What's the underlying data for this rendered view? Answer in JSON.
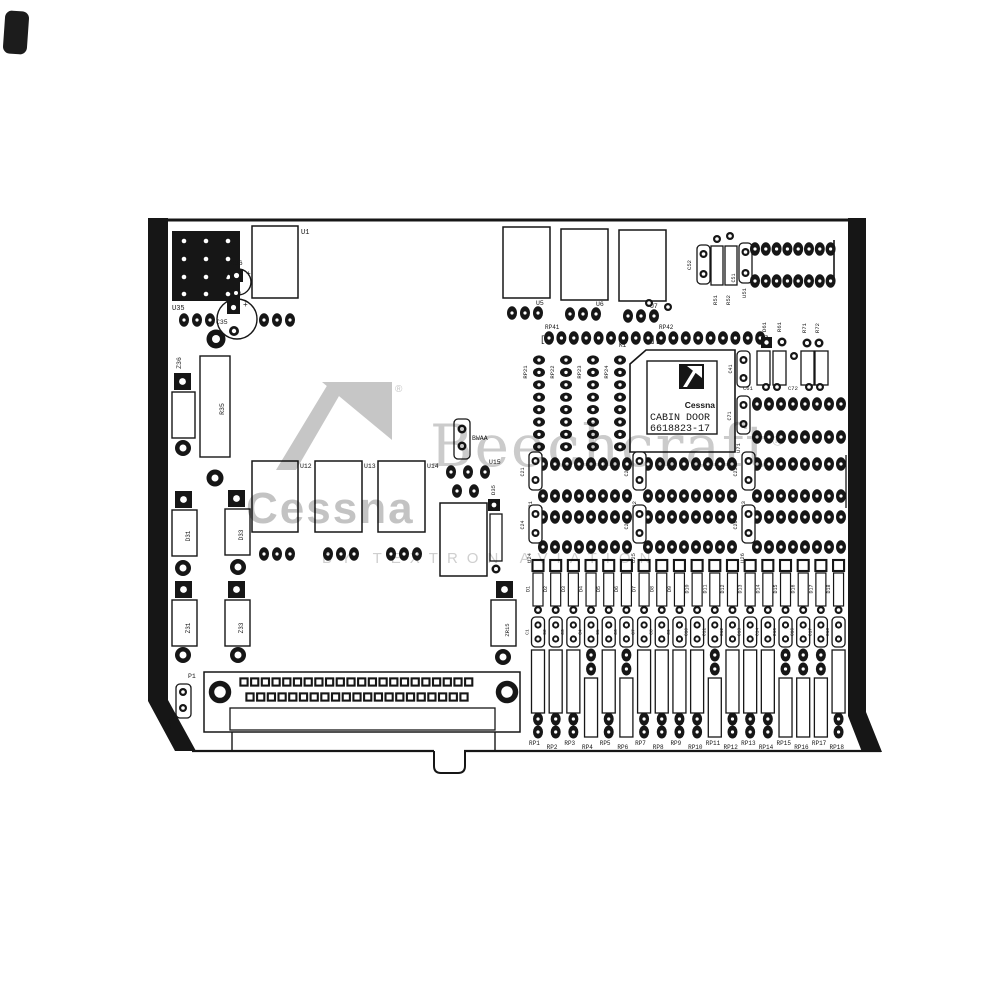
{
  "chip": {
    "brand": "Cessna",
    "product": "CABIN DOOR",
    "part_number": "6618823-17"
  },
  "watermark": {
    "cessna": "Cessna",
    "beechcraft": "Beechcraft",
    "tagline": "BY TEXTRON AVIATION",
    "reg": "®"
  },
  "glyphs": {
    "bracket_open": "[",
    "bracket_close": "]",
    "plus": "+"
  },
  "refdes": {
    "u35": "U35",
    "c36": "C36",
    "u1": "U1",
    "c35": "C35",
    "z36": "Z36",
    "r35": "R35",
    "d31": "D31",
    "d33": "D33",
    "z31": "Z31",
    "z33": "Z33",
    "p1": "P1",
    "c34": "C34",
    "u5": "U5",
    "u6": "U6",
    "u7": "U7",
    "rp41": "RP41",
    "rp42": "RP42",
    "k1": "K1",
    "c52": "C52",
    "r51": "R51",
    "r52": "R52",
    "c51": "C51",
    "u51": "U51",
    "d61": "D61",
    "r61": "R61",
    "r71": "R71",
    "r72": "R72",
    "c61": "C61",
    "c72": "C72",
    "c41": "C41",
    "c71": "C71",
    "u71": "U71",
    "u12": "U12",
    "u13": "U13",
    "u14": "U14",
    "u15": "U15",
    "d35": "D35",
    "bwaa": "BWAA",
    "zr15": "ZR15",
    "c21": "C21",
    "u21": "U21",
    "c22": "C22",
    "u22": "U22",
    "c23": "C23",
    "u23": "U23",
    "c24": "C24",
    "u24": "U24",
    "c25": "C25",
    "u25": "U25",
    "c26": "C26",
    "u26": "U26",
    "rp_mid": [
      "RP21",
      "RP22",
      "RP23",
      "RP24"
    ]
  },
  "bottom_bank": {
    "diodes": [
      "D1",
      "D2",
      "D3",
      "D4",
      "D5",
      "D6",
      "D7",
      "D8",
      "D9",
      "D10",
      "D11",
      "D12",
      "D13",
      "D14",
      "D15",
      "D16",
      "D17",
      "D18"
    ],
    "caps": [
      "C1",
      "C2",
      "C3",
      "C4",
      "C5",
      "C6",
      "C7",
      "C8",
      "C9",
      "C10",
      "C11",
      "C12",
      "C13",
      "C14",
      "C15",
      "C16",
      "C17",
      "C18"
    ],
    "packs": [
      "RP1",
      "RP2",
      "RP3",
      "RP4",
      "RP5",
      "RP6",
      "RP7",
      "RP8",
      "RP9",
      "RP10",
      "RP11",
      "RP12",
      "RP13",
      "RP14",
      "RP15",
      "RP16",
      "RP17",
      "RP18"
    ]
  },
  "colors": {
    "ink": "#161616",
    "watermark_gray": "#c6c6c6",
    "paper": "#ffffff"
  }
}
